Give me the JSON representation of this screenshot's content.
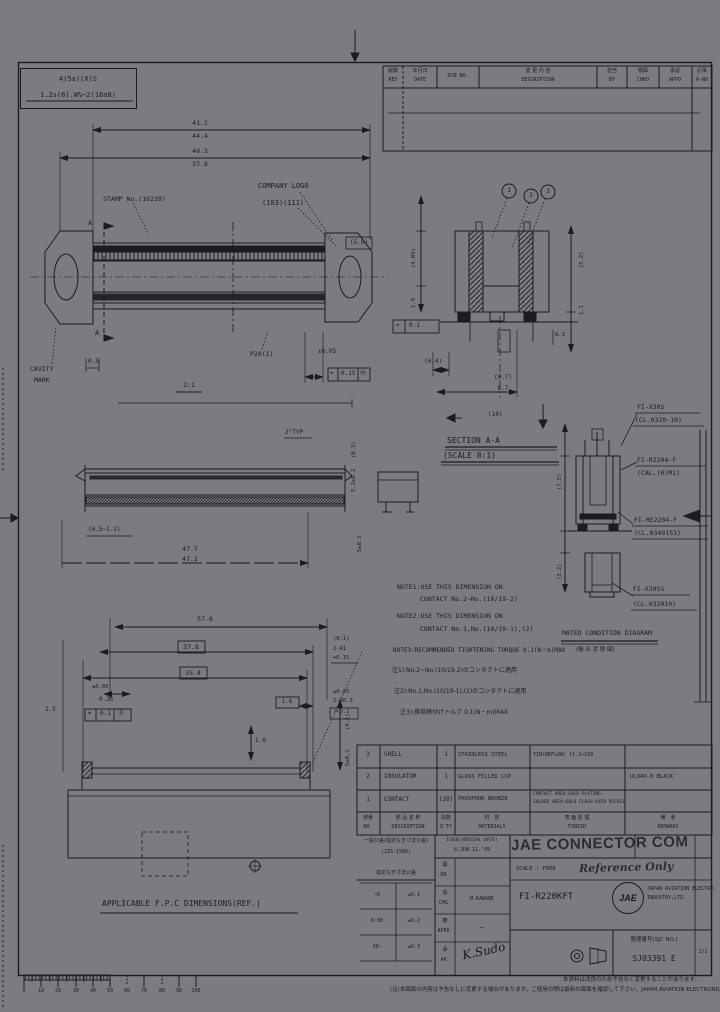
{
  "stamp_box": {
    "line1": "4(5a)(X)S",
    "line2": "1.2s(6).W%~2(16a8)"
  },
  "revision_table": {
    "headers": [
      {
        "jp": "版数",
        "en": "REV"
      },
      {
        "jp": "年月日",
        "en": "DATE"
      },
      {
        "jp": "",
        "en": "DCN NO."
      },
      {
        "jp": "変 更 内 容",
        "en": "DESCRIPTION"
      },
      {
        "jp": "担当",
        "en": "BY"
      },
      {
        "jp": "検図",
        "en": "CHKD"
      },
      {
        "jp": "承認",
        "en": "APPD"
      },
      {
        "jp": "記事",
        "en": "A-NO"
      }
    ]
  },
  "top_view": {
    "stamp_label": "STAMP No.(10220)",
    "company_logo": "COMPANY LOGO",
    "logo_ref": "(103)(111)",
    "dim1_upper": "41.2",
    "dim1_lower": "44.4",
    "dim2_upper": "40.3",
    "dim2_lower": "37.8",
    "section_mark_top": "A",
    "section_mark_bottom": "A",
    "end_ref": "(5.9)",
    "cavity_line1": "CAVITY",
    "cavity_line2": "MARK",
    "dim_05": "0.5",
    "pitch_label": "P20(1)",
    "tol_label": "±0.05",
    "fcf_sym": "⌖",
    "fcf_val": "0.15",
    "fcf_mod": "Ⓜ",
    "view_scale": "2:1"
  },
  "cross_section": {
    "balloons": [
      "1",
      "2",
      "3"
    ],
    "left_dim": "(4.05)",
    "left_dim2": "1.9",
    "fcf_sym": "⌖",
    "fcf_val": "0.1",
    "dim_04": "(0.4)",
    "dim_07": "(0.7)",
    "dim_67": "6.7",
    "right_dim1": "(5.2)",
    "right_dim2": "1.1",
    "right_dim3": "0.3"
  },
  "side_view": {
    "typ_label": "2°TYP",
    "right_dim1": "(0.3)",
    "right_dim2": "5.2±0.2",
    "right_dim3": "5±0.1",
    "left_dim": "(0.5~1.2)",
    "total_upper": "47.7",
    "total_lower": "47.2"
  },
  "section_view": {
    "title": "SECTION A-A",
    "scale": "(SCALE 8:1)",
    "ref": "(10)"
  },
  "mated": {
    "caption": "MATED CONDITION DIAGRAM",
    "caption_jp": "(嵌 合 状 態 図)",
    "left_dim1": "(7.5)",
    "left_dim2": "(3.2)",
    "callouts": [
      {
        "name": "FI-X30S",
        "ref": "(CL.0320-10)"
      },
      {
        "name": "FI-R2204-F",
        "ref": "(CAL.(0)M1)"
      },
      {
        "name": "FI-RE2204-F",
        "ref": "(CL.0349153)"
      },
      {
        "name": "FI-X30SS",
        "ref": "(CL.032010)"
      }
    ]
  },
  "notes": {
    "n1a": "NOTE1:USE THIS DIMENSION ON",
    "n1b": "CONTACT No.2~No.(10/19-2)",
    "n2a": "NOTE2:USE THIS DIMENSION ON",
    "n2b": "CONTACT No.1,No.(10/19-1),(2)",
    "n3": "NOTE3:RECOMMENDED TIGHTENING TORQUE 0.1(N・m)MAX",
    "j1": "注1):No.2~No.(10/19-2)のコンタクトに適用",
    "j2": "注2):No.1,No.(10/19-1),(2)のコンタクトに適用",
    "j3": "注3):推奨締付けトルク 0.1(N・m)MAX"
  },
  "fpc": {
    "caption": "APPLICABLE F.P.C DIMENSIONS(REF.)",
    "dim_578": "57.8",
    "dim_378": "37.8",
    "dim_354": "35.4",
    "dim_16": "1.6",
    "dim_10": "1.0",
    "dim_15": "1.5",
    "tol_005": "±0.05",
    "dim_025": "0.25",
    "fcf_sym": "⌖",
    "fcf_val": "0.1",
    "fcf_mod": "Ⓢ",
    "r1a": "(0.1)",
    "r1b": "2-R1",
    "r1c": "⌖0.15",
    "r2a": "±0.05",
    "r2b": "2-R0.3",
    "r2c": "＝0.1",
    "rv1": "(4.1)",
    "rv2": "5±0.1"
  },
  "bom": {
    "headers": [
      {
        "jp": "部番",
        "en": "NO."
      },
      {
        "jp": "部 品 名 称",
        "en": "DESCRIPTION"
      },
      {
        "jp": "員数",
        "en": "Q'TY"
      },
      {
        "jp": "材　質",
        "en": "MATERIALS"
      },
      {
        "jp": "表 面 処 理",
        "en": "FINISH"
      },
      {
        "jp": "備　考",
        "en": "REMARKS"
      }
    ],
    "rows": [
      {
        "no": "3",
        "desc": "SHELL",
        "qty": "1",
        "mat": "STAINLESS STEEL",
        "fin1": "TIN(REFLOW) t1.2×150",
        "fin2": "",
        "rem": ""
      },
      {
        "no": "2",
        "desc": "INSULATOR",
        "qty": "1",
        "mat": "GLASS FILLED LCP",
        "fin1": "",
        "fin2": "",
        "rem": "UL94V-0 BLACK"
      },
      {
        "no": "1",
        "desc": "CONTACT",
        "qty": "(20)",
        "mat": "PHOSPHOR BRONZE",
        "fin1": "CONTACT AREA:GOLD PLATING",
        "fin2": "SOLDER AREA:GOLD FLASH OVER NICKEL",
        "rem": ""
      }
    ]
  },
  "title_block": {
    "tol_note1": "一般公差(指定なき寸法公差)",
    "tol_note2": "(JIS-1986)",
    "tol_caption": "指定なき寸法公差",
    "tol_rows": [
      [
        "~6",
        "±0.1"
      ],
      [
        "6~30",
        "±0.2"
      ],
      [
        "30~",
        "±0.3"
      ]
    ],
    "issue_label": "ISSUE(REVISAL DATE)",
    "issue_value": "8.JUN.11.'99",
    "sig_rows": [
      {
        "jp": "図",
        "en": "DR.",
        "val": ""
      },
      {
        "jp": "設",
        "en": "CHG.",
        "val": "M.KAWABE"
      },
      {
        "jp": "審",
        "en": "APPD.",
        "val": "—"
      },
      {
        "jp": "承",
        "en": "AP.",
        "val": "K.Sudo"
      }
    ],
    "watermark": "JAE CONNECTOR COM",
    "reference_stamp": "Reference Only",
    "scale_label": "SCALE : FREE",
    "part_no": "FI-R220KFT",
    "logo_text": "JAE",
    "company_line1": "JAPAN AVIATION ELECTRO.",
    "company_line2": "INDUSTRY,LTD.",
    "dwg_label": "整理番号(SJC NO.)",
    "dwg_no": "SJ03391 E",
    "sheet_no": "1/1"
  },
  "ruler": {
    "labels": [
      "0",
      "10",
      "20",
      "30",
      "40",
      "50",
      "60",
      "70",
      "80",
      "90",
      "100"
    ]
  },
  "footer": {
    "line1": "本資料は改良のため予告なく変更することがあります。",
    "line2": "(注)本図面の内容は予告なしに変更する場合があります。ご使用の際は最新の図面を確認して下さい。JAPAN AVIATION ELECTRONICS IND.,LTD."
  }
}
